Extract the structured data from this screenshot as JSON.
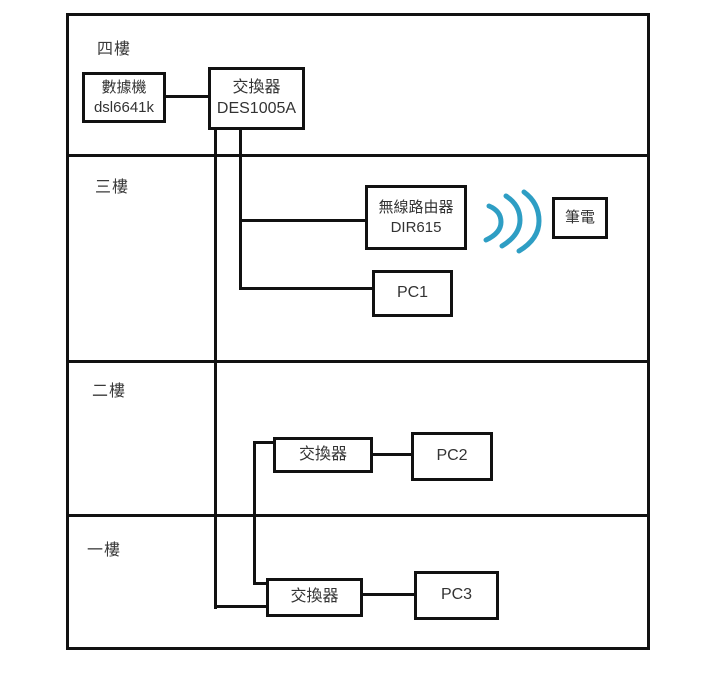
{
  "diagram": {
    "floors": [
      {
        "id": "floor-4",
        "label": "四樓"
      },
      {
        "id": "floor-3",
        "label": "三樓"
      },
      {
        "id": "floor-2",
        "label": "二樓"
      },
      {
        "id": "floor-1",
        "label": "一樓"
      }
    ],
    "nodes": {
      "modem": {
        "name": "數據機",
        "model": "dsl6641k"
      },
      "switch_4f": {
        "name": "交換器",
        "model": "DES1005A"
      },
      "wireless_router": {
        "name": "無線路由器",
        "model": "DIR615"
      },
      "laptop": {
        "name": "筆電"
      },
      "pc1": {
        "name": "PC1"
      },
      "switch_2f": {
        "name": "交換器"
      },
      "pc2": {
        "name": "PC2"
      },
      "switch_1f": {
        "name": "交換器"
      },
      "pc3": {
        "name": "PC3"
      }
    },
    "colors": {
      "line": "#111111",
      "wifi_signal": "#2E9EC4"
    }
  }
}
